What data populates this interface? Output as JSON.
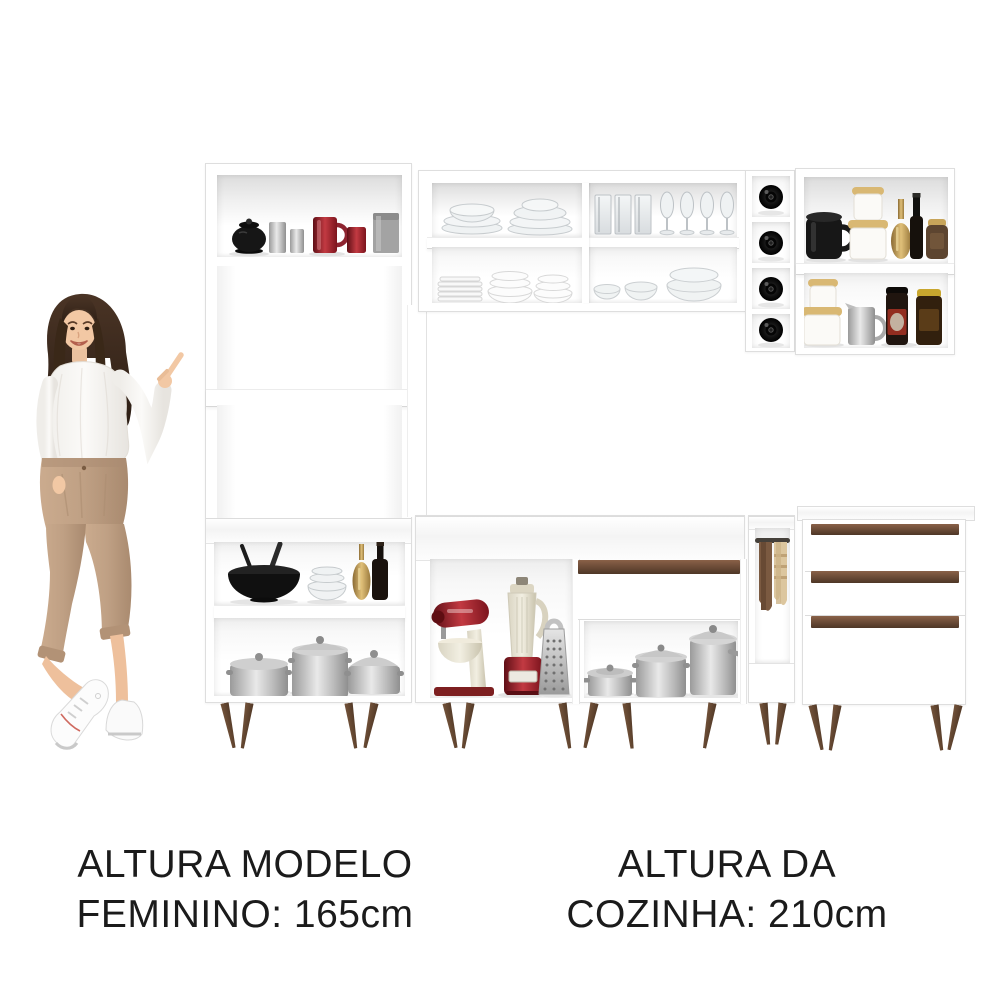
{
  "captions": {
    "model": {
      "line1": "ALTURA MODELO",
      "line2": "FEMININO: 165cm"
    },
    "kitchen": {
      "line1": "ALTURA DA",
      "line2": "COZINHA: 210cm"
    }
  },
  "palette": {
    "page_bg": "#ffffff",
    "cabinet_white": "#ffffff",
    "cabinet_edge": "#dedede",
    "accent_trim_top": "#8a6148",
    "accent_trim_bottom": "#4e3626",
    "leg_wood_light": "#7c5a40",
    "leg_wood_dark": "#4a3322",
    "caption_text": "#1b1b1b",
    "red_mug": "#8e2430",
    "pots_silver": "#a8a8a8",
    "towel_brown": "#7b5a41",
    "towel_beige": "#dcc69e",
    "pants_tan": "#bfa084",
    "hair_brown": "#3a2a1f"
  },
  "visible_items": [
    "coffee-mugs-and-canister",
    "glass-dinnerware",
    "drinking-glasses",
    "champagne-flutes",
    "white-plates-and-bowls",
    "glass-bowls",
    "wine-bottles",
    "pantry-canisters-and-jars",
    "coffee-jars",
    "black-salad-bowl",
    "carafe-and-wine-bottle",
    "aluminum-pots",
    "stand-mixer",
    "blender",
    "box-grater",
    "dish-towels"
  ]
}
